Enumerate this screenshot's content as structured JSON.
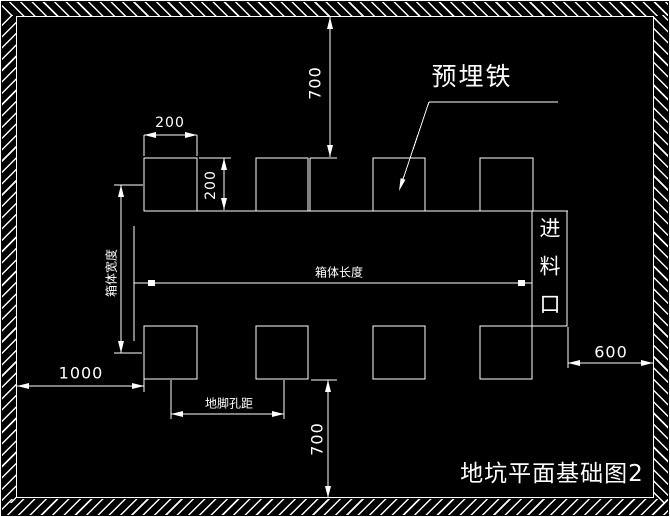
{
  "drawing": {
    "title": "地坑平面基础图2",
    "callout_label": "预埋铁",
    "feed_inlet_label": "进料口",
    "dim_labels": {
      "box_length": "箱体长度",
      "box_width": "箱体宽度",
      "anchor_hole_spacing": "地脚孔距"
    },
    "dim_values": {
      "pad_width": "200",
      "pad_height": "200",
      "top_clearance": "700",
      "bottom_clearance": "700",
      "left_clearance": "1000",
      "right_clearance": "600"
    },
    "colors": {
      "line": "#ffffff",
      "background": "#000000"
    }
  }
}
